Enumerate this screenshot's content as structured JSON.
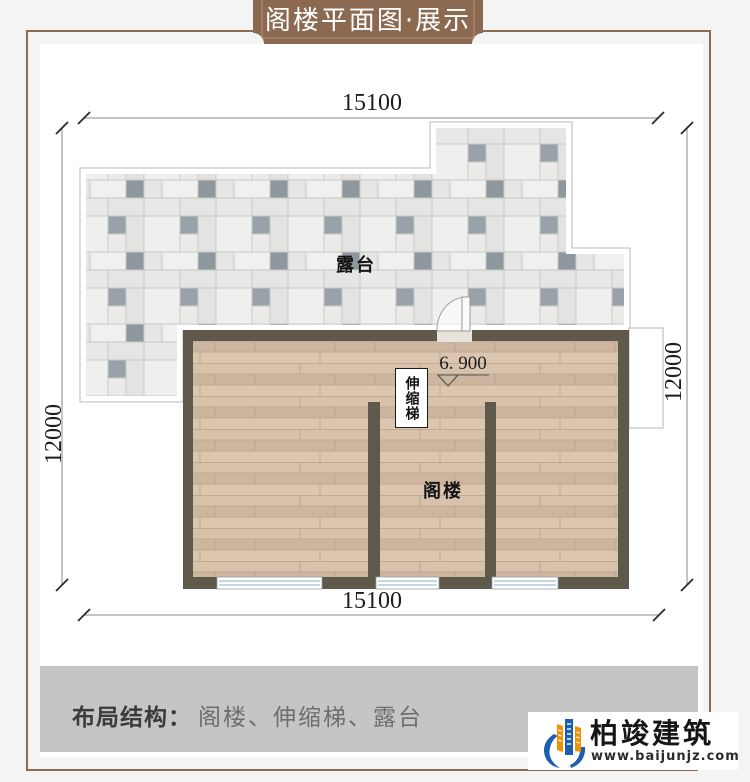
{
  "banner": {
    "title": "阁楼平面图·展示"
  },
  "plan": {
    "dimensions": {
      "top": "15100",
      "bottom": "15100",
      "left": "12000",
      "right": "12000"
    },
    "elevation": "6. 900",
    "rooms": {
      "terrace": "露台",
      "attic": "阁楼",
      "ladder": "伸缩梯"
    }
  },
  "footer": {
    "label": "布局结构：",
    "items": "阁楼、伸缩梯、露台"
  },
  "logo": {
    "name": "柏竣建筑",
    "url": "www.baijunjz.com"
  },
  "colors": {
    "banner_brown": "#8c6a52",
    "frame_brown": "#8d6b52",
    "wall": "#5e594b",
    "wood_base": "#d5bfa9",
    "tile_light": "#e9e9e7",
    "tile_dark": "#98a0a8",
    "window_blue": "#aecbd8",
    "footer_bar": "#c5c5c5",
    "logo_blue": "#1d5fae",
    "logo_orange": "#f29200"
  }
}
